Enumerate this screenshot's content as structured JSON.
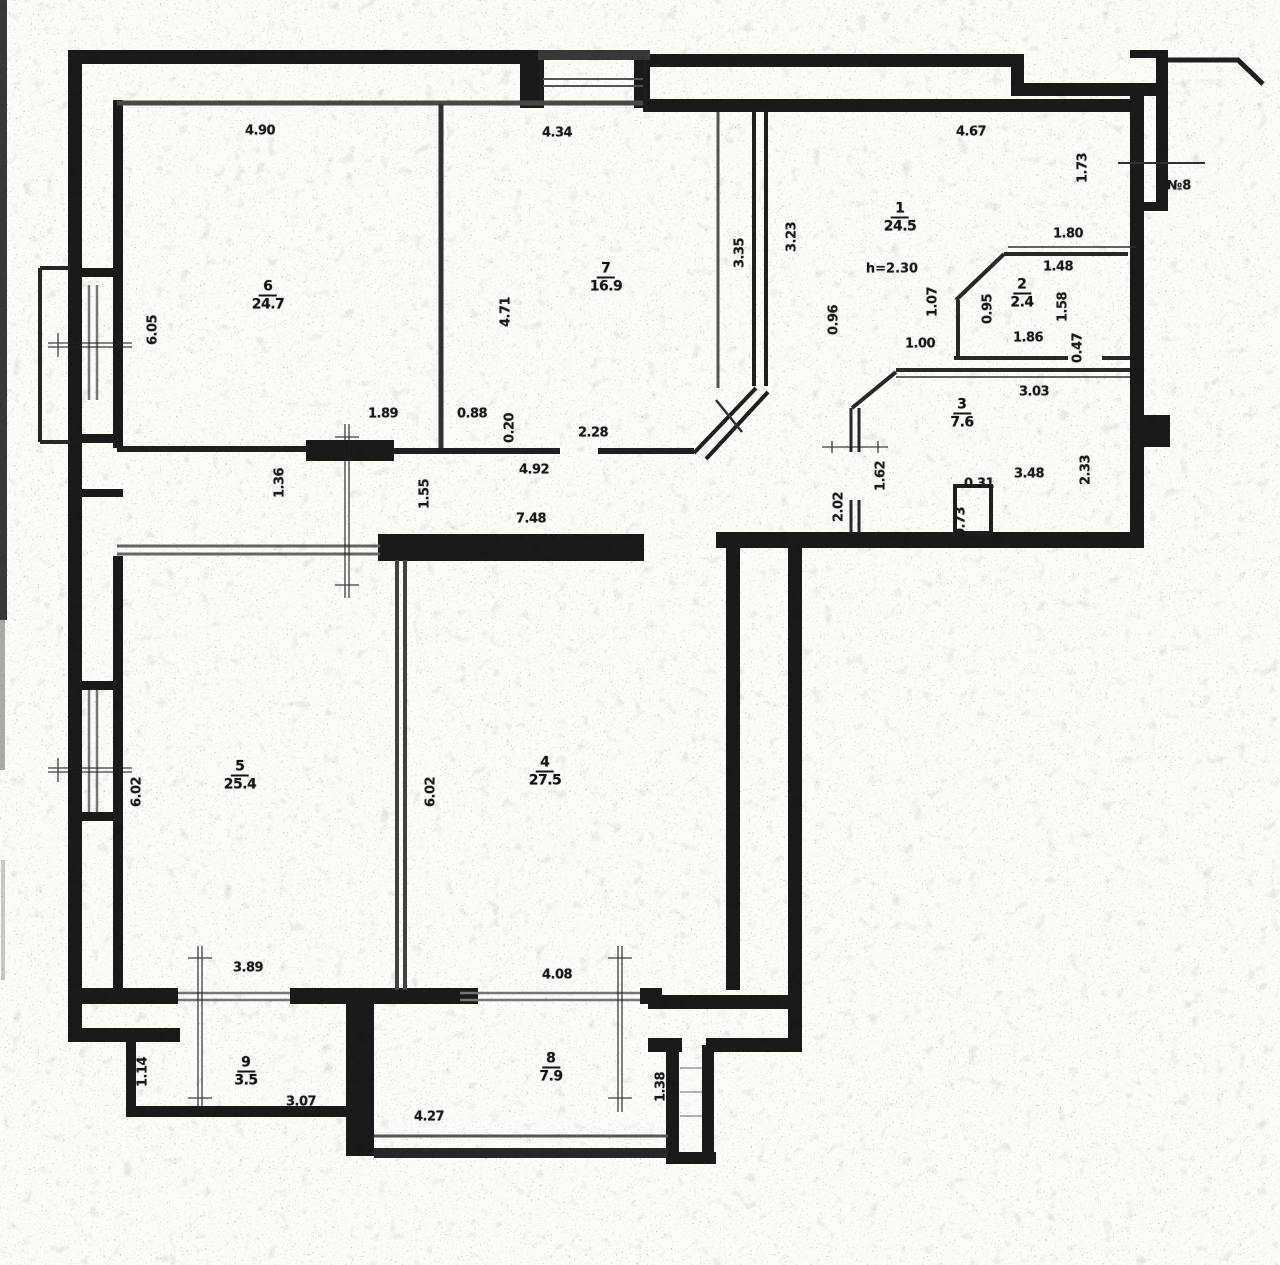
{
  "document": {
    "kind": "scanned apartment floor plan",
    "colors": {
      "paper": "#f7f7f4",
      "wall": "#1d1d1d",
      "thin_line": "#333333",
      "glazing": "#777777"
    }
  },
  "plan": {
    "rooms": [
      {
        "number": "6",
        "area": "24.7",
        "x": 268,
        "y": 296
      },
      {
        "number": "7",
        "area": "16.9",
        "x": 606,
        "y": 278
      },
      {
        "number": "1",
        "area": "24.5",
        "x": 900,
        "y": 218
      },
      {
        "number": "2",
        "area": "2.4",
        "x": 1022,
        "y": 294
      },
      {
        "number": "3",
        "area": "7.6",
        "x": 962,
        "y": 414
      },
      {
        "number": "5",
        "area": "25.4",
        "x": 240,
        "y": 776
      },
      {
        "number": "4",
        "area": "27.5",
        "x": 545,
        "y": 772
      },
      {
        "number": "9",
        "area": "3.5",
        "x": 246,
        "y": 1072
      },
      {
        "number": "8",
        "area": "7.9",
        "x": 551,
        "y": 1068
      }
    ],
    "dimensions": [
      {
        "t": "4.90",
        "x": 260,
        "y": 131,
        "r": 0
      },
      {
        "t": "4.34",
        "x": 557,
        "y": 133,
        "r": 0
      },
      {
        "t": "4.67",
        "x": 971,
        "y": 132,
        "r": 0
      },
      {
        "t": "1.73",
        "x": 1083,
        "y": 168,
        "r": -90
      },
      {
        "t": "1.80",
        "x": 1068,
        "y": 234,
        "r": 0
      },
      {
        "t": "1.48",
        "x": 1058,
        "y": 267,
        "r": 0
      },
      {
        "t": "3.23",
        "x": 792,
        "y": 237,
        "r": -90
      },
      {
        "t": "3.35",
        "x": 740,
        "y": 253,
        "r": -90
      },
      {
        "t": "1.07",
        "x": 933,
        "y": 302,
        "r": -90
      },
      {
        "t": "0.95",
        "x": 988,
        "y": 309,
        "r": -90
      },
      {
        "t": "1.58",
        "x": 1063,
        "y": 307,
        "r": -90
      },
      {
        "t": "1.86",
        "x": 1028,
        "y": 338,
        "r": 0
      },
      {
        "t": "1.00",
        "x": 920,
        "y": 344,
        "r": 0
      },
      {
        "t": "0.47",
        "x": 1078,
        "y": 348,
        "r": -90
      },
      {
        "t": "6.05",
        "x": 153,
        "y": 330,
        "r": -90
      },
      {
        "t": "4.71",
        "x": 506,
        "y": 312,
        "r": -90
      },
      {
        "t": "0.96",
        "x": 834,
        "y": 320,
        "r": -90
      },
      {
        "t": "3.03",
        "x": 1034,
        "y": 392,
        "r": 0
      },
      {
        "t": "1.89",
        "x": 383,
        "y": 414,
        "r": 0
      },
      {
        "t": "0.88",
        "x": 472,
        "y": 414,
        "r": 0
      },
      {
        "t": "0.20",
        "x": 510,
        "y": 428,
        "r": -90
      },
      {
        "t": "2.28",
        "x": 593,
        "y": 433,
        "r": 0
      },
      {
        "t": "1.36",
        "x": 280,
        "y": 483,
        "r": -90
      },
      {
        "t": "1.62",
        "x": 881,
        "y": 476,
        "r": -90
      },
      {
        "t": "0.31",
        "x": 979,
        "y": 484,
        "r": 0
      },
      {
        "t": "3.48",
        "x": 1029,
        "y": 474,
        "r": 0
      },
      {
        "t": "2.33",
        "x": 1086,
        "y": 470,
        "r": -90
      },
      {
        "t": "2.02",
        "x": 839,
        "y": 507,
        "r": -90
      },
      {
        "t": "0.73",
        "x": 961,
        "y": 522,
        "r": -90
      },
      {
        "t": "1.55",
        "x": 425,
        "y": 494,
        "r": -90
      },
      {
        "t": "4.92",
        "x": 534,
        "y": 470,
        "r": 0
      },
      {
        "t": "7.48",
        "x": 531,
        "y": 519,
        "r": 0
      },
      {
        "t": "6.02",
        "x": 137,
        "y": 792,
        "r": -90
      },
      {
        "t": "6.02",
        "x": 431,
        "y": 792,
        "r": -90
      },
      {
        "t": "3.89",
        "x": 248,
        "y": 968,
        "r": 0
      },
      {
        "t": "4.08",
        "x": 557,
        "y": 975,
        "r": 0
      },
      {
        "t": "1.14",
        "x": 143,
        "y": 1072,
        "r": -90
      },
      {
        "t": "3.07",
        "x": 301,
        "y": 1102,
        "r": 0
      },
      {
        "t": "4.27",
        "x": 429,
        "y": 1117,
        "r": 0
      },
      {
        "t": "1.38",
        "x": 661,
        "y": 1087,
        "r": -90
      }
    ],
    "annotations": [
      {
        "t": "№8",
        "x": 1179,
        "y": 186
      },
      {
        "t": "h=2.30",
        "x": 892,
        "y": 269
      }
    ]
  }
}
